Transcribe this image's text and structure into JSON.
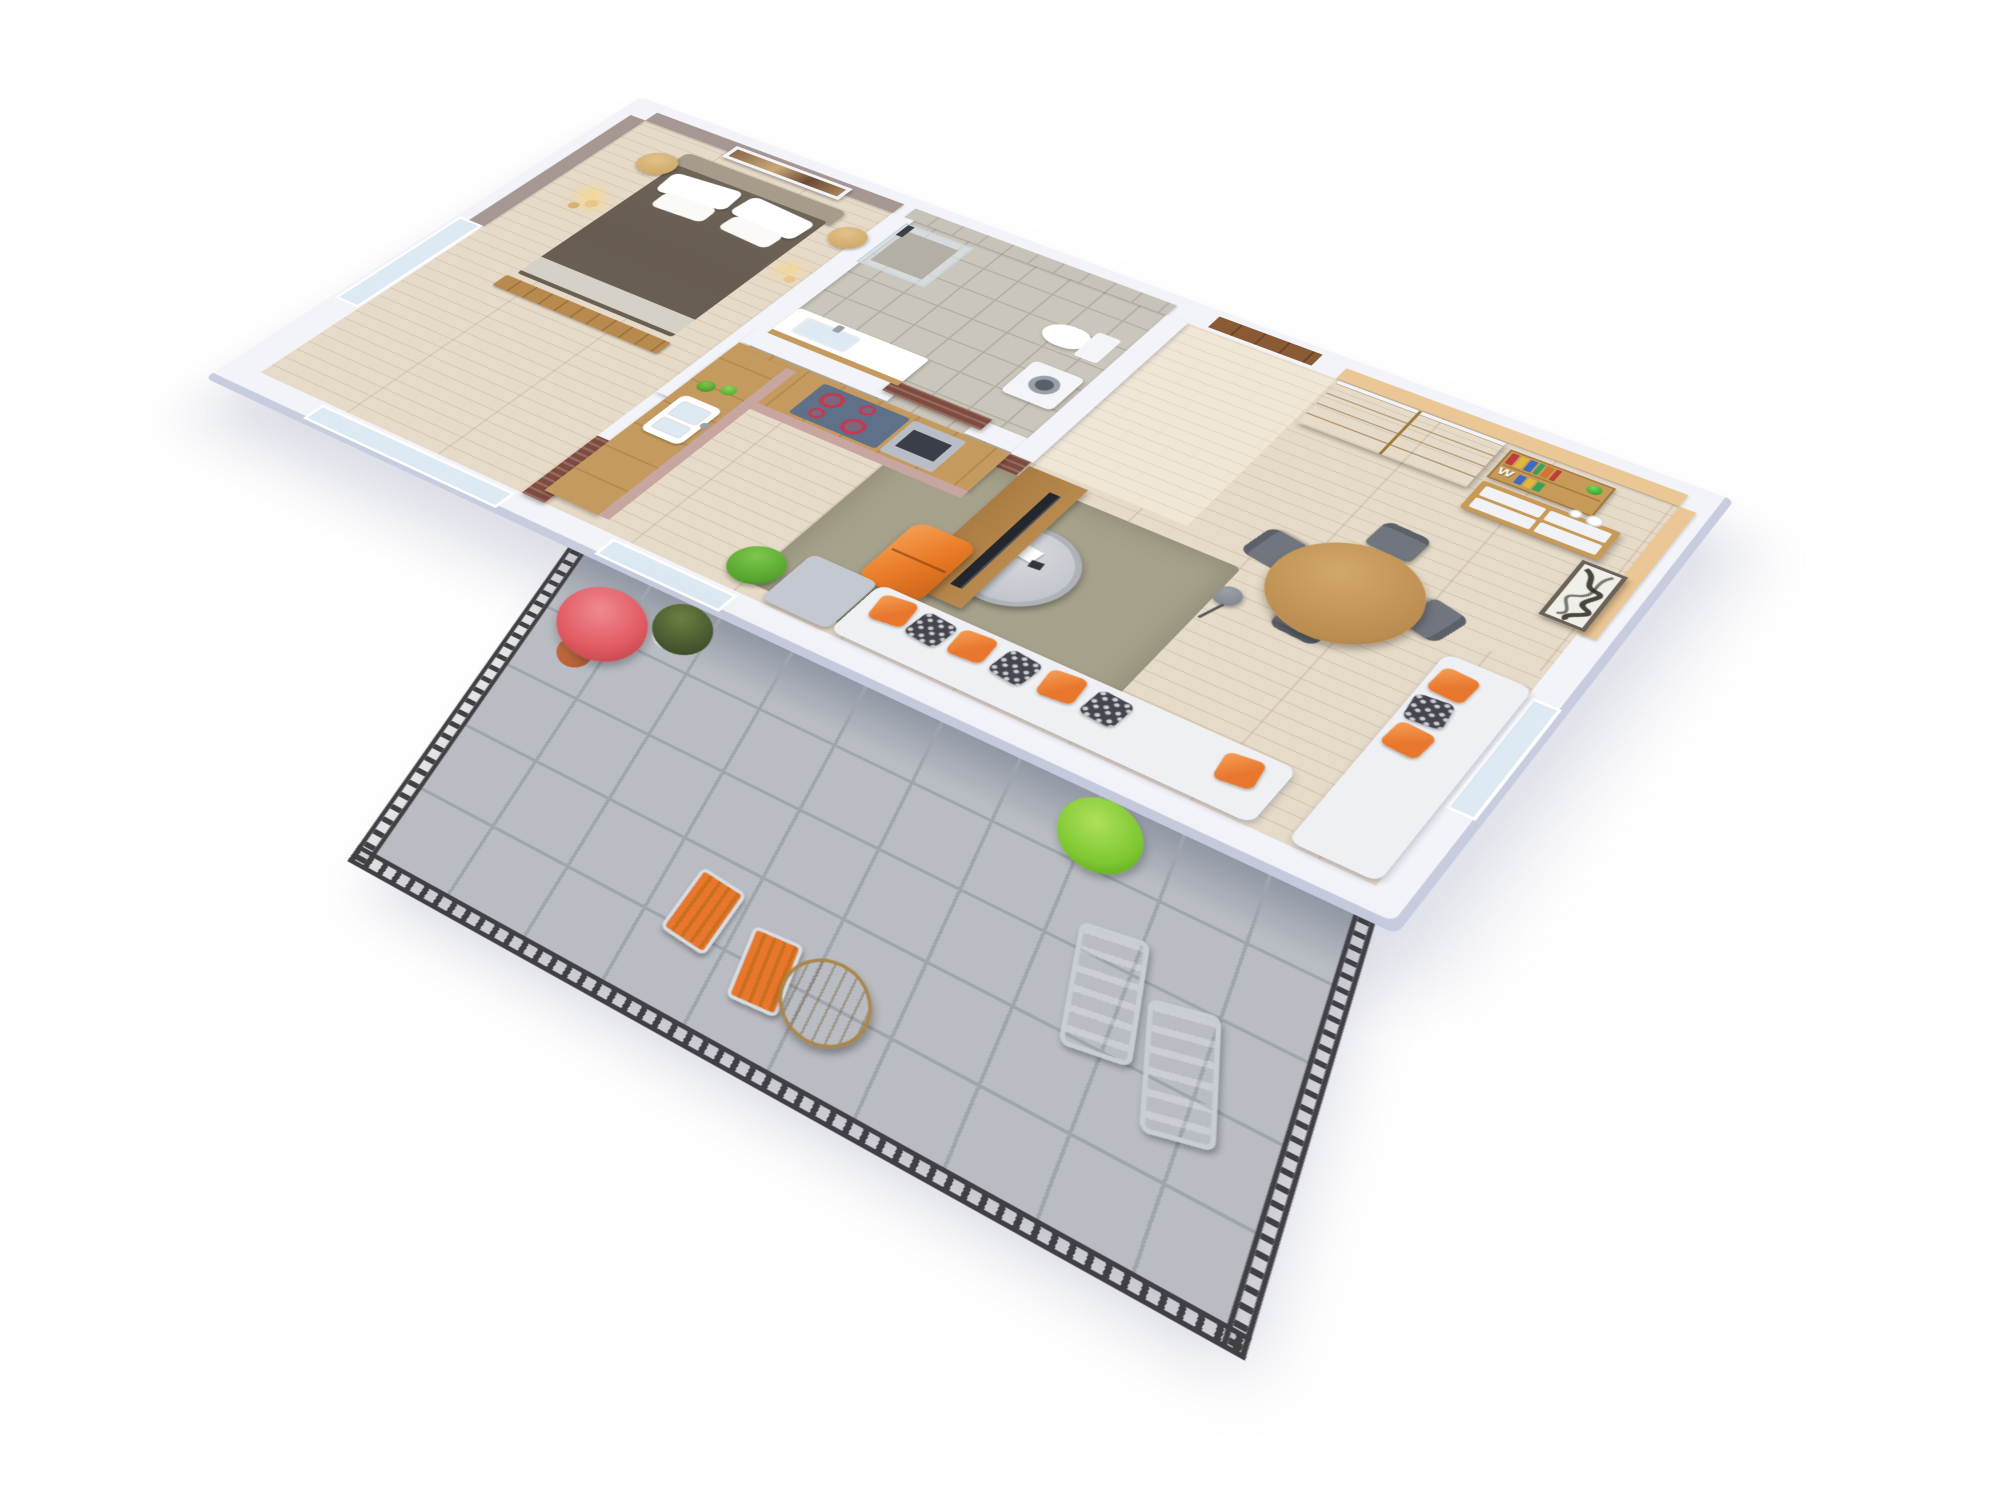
{
  "meta": {
    "type": "3d-floorplan-render",
    "description": "Photorealistic high-angle 3D floor plan of a one-bedroom apartment with wrap balcony, white exterior walls on a white background",
    "view": "rotated axonometric / aerial cutaway, long axis running to lower-right"
  },
  "decor": {
    "shelf_letter": "W"
  },
  "palette": {
    "wall_white": "#f3f4f9",
    "wall_shade": "#c7cdde",
    "taupe_wall": "#a69792",
    "tile_grey": "#c7c3b8",
    "tile_grout": "#b3afa4",
    "tan_wall": "#eac795",
    "wood_floor": "#e6dac8",
    "hall_floor": "#efe6d6",
    "bath_floor": "#cac6bb",
    "rug_olive": "#a6a18b",
    "balcony_tile": "#b9bdc3",
    "balcony_grout": "#a0a5ad",
    "railing_dark": "#3f3f44",
    "oak_wood": "#c49557",
    "oak_line": "#9e7a3f",
    "entry_door": "#8a5a35",
    "slat_wood": "#7e4b3f",
    "kitchen_counter": "#c59a5e",
    "cabinet_pink": "#c7a5a0",
    "hob_steel": "#5f7089",
    "burner_red": "#c23a50",
    "oven_steel": "#b9bec6",
    "oven_glass": "#3a3f47",
    "fridge_orange": "#e87a25",
    "fridge_hi": "#f6a056",
    "tv_black": "#23262c",
    "tv_unit": "#b98a4e",
    "sofa_white": "#eef0f4",
    "chaise_grey": "#c3c8d1",
    "pillow_orange": "#e8762c",
    "pillow_dark": "#45454f",
    "bed_duvet": "#675c51",
    "headboard": "#a79b8c",
    "sheet_white": "#e9e5dc",
    "bench_wood": "#b98a4e",
    "gold": "#c9a15e",
    "glass_blue": "#dde9f3",
    "maple_red": "#e25b63",
    "topiary_green": "#45562f",
    "plant_green": "#55a22e",
    "bright_green": "#7ec832",
    "pot_terracotta": "#b0572f",
    "pot_white": "#f1f2f5",
    "pot_grey": "#8e939e",
    "chair_grey": "#71757d",
    "chair_dark": "#5c6068",
    "dining_wood": "#bb8d50",
    "lamp_grey": "#7b8089",
    "coffee_grey": "#c2c6cc",
    "coffee_top": "#d8dbdf",
    "art_frame": "#6b6258",
    "art_paper": "#f1efe9",
    "ink_black": "#2a2620",
    "shelf_wood": "#c89a58",
    "book_red": "#c23b3b",
    "book_yellow": "#e0b93c",
    "book_blue": "#3b6bc2",
    "book_green": "#3ba05a",
    "book_orange": "#d0762e"
  },
  "scene": {
    "rooms": [
      {
        "name": "bedroom",
        "items": [
          "double bed with brown duvet",
          "grey headboard",
          "white pillows",
          "wood bench at foot",
          "two round gold side tables",
          "pendant light clusters",
          "framed abstract painting on taupe wall",
          "corner windows"
        ]
      },
      {
        "name": "bathroom",
        "items": [
          "glass shower cabin",
          "black shower column",
          "wall-hung toilet",
          "front-load washing machine",
          "white sink counter",
          "grey wall tiles",
          "dark wood sliding door"
        ]
      },
      {
        "name": "hallway",
        "items": [
          "brown entry door",
          "oak sliding-door wardrobe"
        ]
      },
      {
        "name": "kitchen",
        "items": [
          "L-shaped wood counter",
          "induction hob with red rings",
          "built-in oven",
          "white sink",
          "herb pots",
          "pink-mauve cabinet fronts",
          "orange retro fridge"
        ]
      },
      {
        "name": "living-dining",
        "items": [
          "wood TV unit",
          "flat-screen TV",
          "dark wood slat partition",
          "round dining table",
          "four grey chairs",
          "tripod floor lamp",
          "wall bookshelf with colorful books",
          "white W decor letter",
          "green vase",
          "sideboard with white drawers",
          "black-and-white ink artwork",
          "tan accent wall",
          "olive rug",
          "round designer coffee table",
          "L-shaped white sofa",
          "orange and patterned pillows",
          "grey chaise",
          "potted green plant"
        ]
      },
      {
        "name": "balcony",
        "items": [
          "black metal railing",
          "grey floor tiles",
          "red maple bonsai in pot",
          "boxwood topiary in white planter",
          "bright green shrub",
          "two grey lounge chairs",
          "two orange folding chairs",
          "round wood bistro table"
        ]
      }
    ]
  }
}
